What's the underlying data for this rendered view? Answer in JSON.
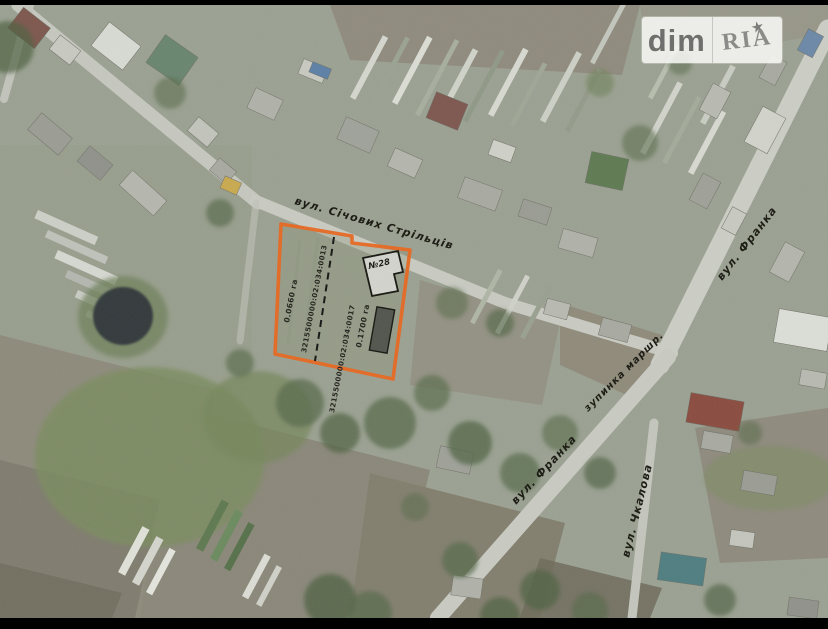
{
  "watermark": {
    "brand_left": "dim",
    "brand_right": "RIA",
    "star": "★"
  },
  "map": {
    "street_labels": [
      {
        "id": "sichovykh-striltsiv",
        "text": "вул. Січових Стрільців"
      },
      {
        "id": "franka-north",
        "text": "вул. Франка"
      },
      {
        "id": "franka-south",
        "text": "вул. Франка"
      },
      {
        "id": "chkalova",
        "text": "вул. Чкалова"
      },
      {
        "id": "bus-stop",
        "text": "зупинка маршр."
      }
    ],
    "parcel": {
      "outline_color": "#e8661f",
      "left_lot": {
        "cadastral": "3215500000:02:034:0013",
        "area": "0.0660 га"
      },
      "right_lot": {
        "cadastral": "3215500000:02:034:0017",
        "area": "0.1700 га"
      },
      "building_label": "№28"
    }
  }
}
